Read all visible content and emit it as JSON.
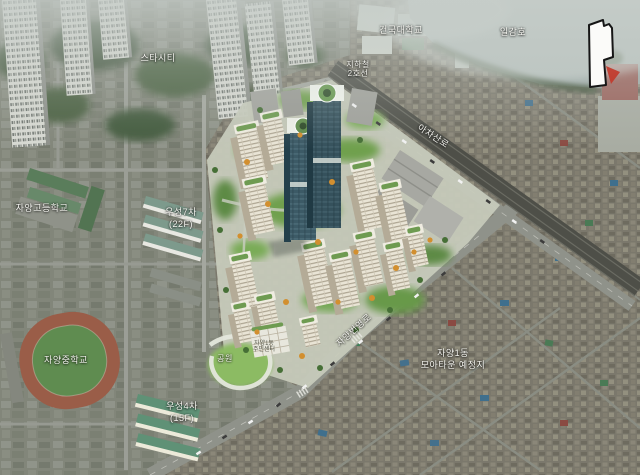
{
  "scene": {
    "labels": {
      "star_city": "스타시티",
      "konkuk_university": "건국대학교",
      "ilgam_lake": "일감호",
      "rail_line_1": "지하철",
      "rail_line_2": "2호선",
      "achasan_ro": "아차산로",
      "jayang_high_school": "자양고등학교",
      "wooseong7_name": "우성7차",
      "wooseong7_floors": "(22F)",
      "jayang_middle_school": "자양중학교",
      "wooseong4_name": "우성4차",
      "wooseong4_floors": "(15F)",
      "park": "공원",
      "jayang_beonyeong_ro": "자양번영로",
      "moatown_line1": "자양1동",
      "moatown_line2": "모아타운 예정지",
      "civic_building_line1": "자양1동",
      "civic_building_line2": "주민센터"
    },
    "icons": {
      "site_locator_icon": "white site-outline polygon",
      "red_arrow_icon": "red arrow pointing at site"
    },
    "colors": {
      "label_text": "#f4f4ef",
      "locator_fill": "#fbfbf9",
      "locator_stroke": "#161616",
      "arrow_red": "#c23a2b",
      "render_green": "#6fa04e",
      "glass_tower": "#3c5a66"
    }
  }
}
